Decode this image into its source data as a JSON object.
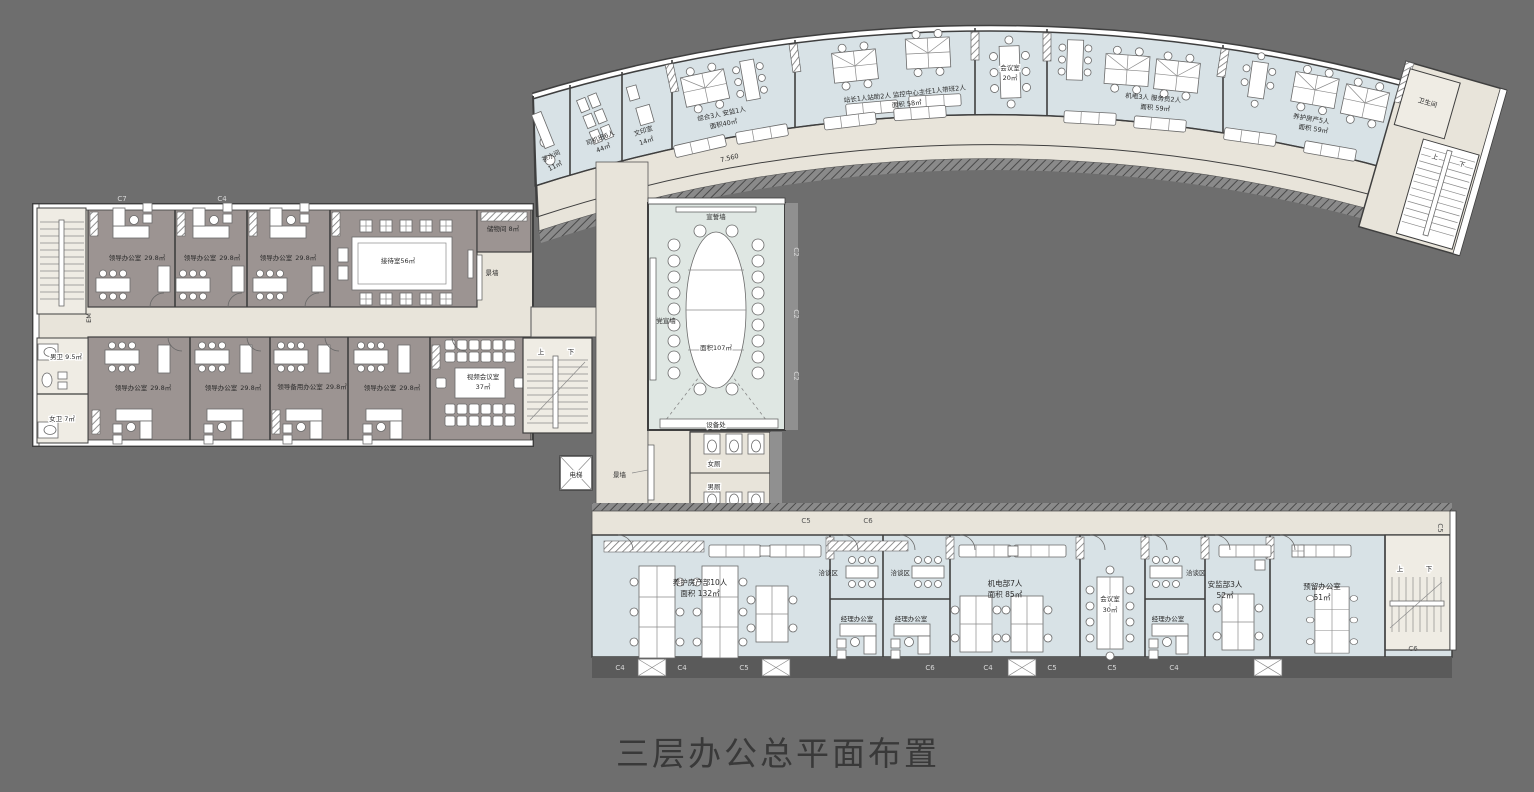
{
  "title": "三层办公总平面布置",
  "colors": {
    "background": "#6e6e6e",
    "room_blue": "#d8e2e6",
    "room_warm_gray": "#9c9492",
    "corridor_beige": "#e8e4da",
    "wall_dark": "#3f3f3f",
    "dark_band": "#5a5a5a",
    "title_text": "#393939"
  },
  "curved_wing": {
    "tea_room": {
      "name": "茶水间",
      "area": "11㎡"
    },
    "driver_room": {
      "name": "司机班6人",
      "area": "44㎡"
    },
    "print_room": {
      "name": "文印室",
      "area": "14㎡"
    },
    "general_office": {
      "name": "综合3人 安监1人",
      "area": "面积40㎡"
    },
    "station_office": {
      "name": "站长1人站助2人 监控中心主任1人带班2人",
      "area": "面积 58㎡"
    },
    "meeting_room": {
      "name": "会议室",
      "area": "20㎡"
    },
    "mech_office": {
      "name": "机电3人 服务员2人",
      "area": "面积 59㎡"
    },
    "maintenance_office": {
      "name": "养护房产5人",
      "area": "面积 59㎡"
    },
    "toilet": "卫生间",
    "corridor_elevation": "7.560"
  },
  "left_wing": {
    "leader_office": {
      "name": "领导办公室",
      "area": "29.8㎡"
    },
    "spare_office": {
      "name": "领导备用办公室",
      "area": "29.8㎡"
    },
    "reception_room": "接待室56㎡",
    "storage_room": "储物间 8㎡",
    "video_conference": {
      "name": "视频会议室",
      "area": "37㎡"
    },
    "men_wc": "男卫 9.5㎡",
    "women_wc": "女卫 7㎡",
    "elevator_code": "EM"
  },
  "central": {
    "oath_wall": "宣誓墙",
    "party_wall": "党宣墙",
    "hall_area": "面积107㎡",
    "equipment": "设备处",
    "women_wc": "女厕",
    "men_wc": "男厕",
    "feature_wall": "景墙",
    "elevator": "电梯"
  },
  "bottom_wing": {
    "maintenance_dept": {
      "name": "养护房产部10人",
      "area": "面积 132㎡"
    },
    "negotiation_area": "洽谈区",
    "manager_office": "经理办公室",
    "mech_dept": {
      "name": "机电部7人",
      "area": "面积 85㎡"
    },
    "meeting_room": {
      "name": "会议室",
      "area": "30㎡"
    },
    "safety_dept": {
      "name": "安监部3人",
      "area": "52㎡"
    },
    "reserved_office": {
      "name": "预留办公室",
      "area": "51㎡"
    }
  },
  "stairs": {
    "up": "上",
    "down": "下"
  },
  "grid_labels": [
    "C7",
    "C4",
    "C2",
    "C2",
    "C2",
    "C5",
    "C6",
    "C4",
    "C4",
    "C5",
    "C6",
    "C4",
    "C5",
    "C5",
    "C4",
    "C6",
    "C5"
  ]
}
